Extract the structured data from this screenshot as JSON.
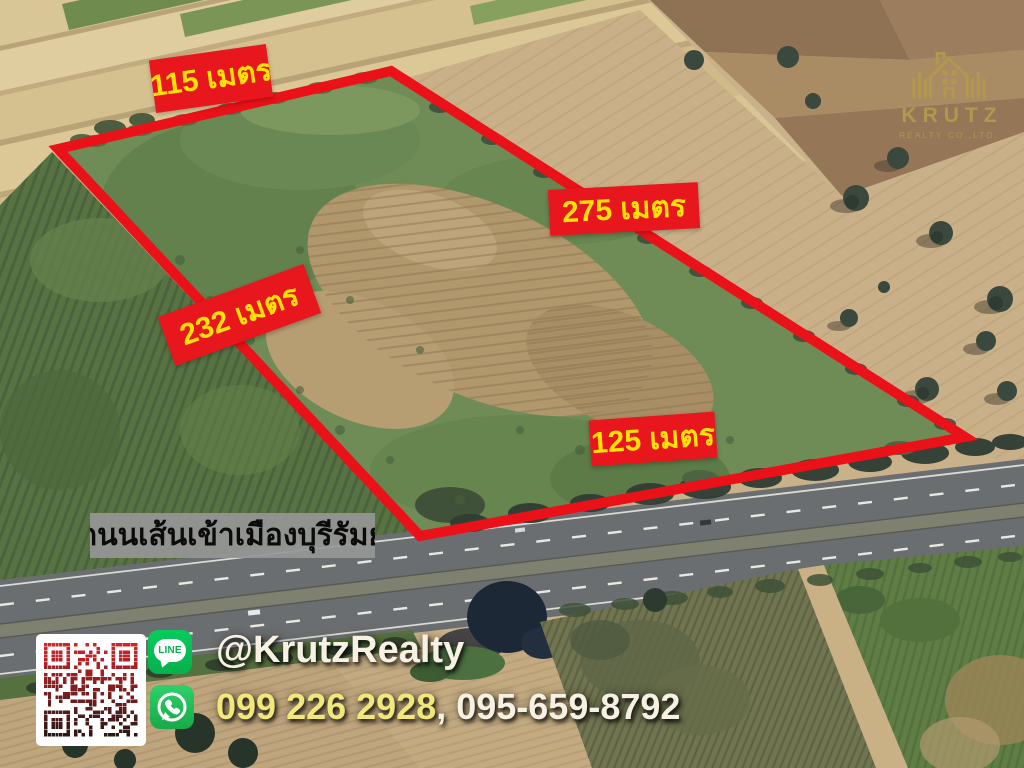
{
  "logo": {
    "name": "KRUTZ",
    "subtitle": "REALTY CO.,LTD.",
    "color": "#b3974e"
  },
  "parcel": {
    "side_labels": {
      "top": "115 เมตร",
      "right": "275 เมตร",
      "left": "232 เมตร",
      "bottom": "125 เมตร"
    },
    "boundary_color": "#ea1118",
    "label_background": "#e8161d",
    "label_text_color": "#ffe204"
  },
  "road": {
    "name": "ถนนเส้นเข้าเมืองบุรีรัมย์"
  },
  "contact": {
    "line_label": "LINE",
    "line_handle": "@KrutzRealty",
    "phone_primary": "099 226 2928",
    "phone_separator": ", ",
    "phone_secondary": "095-659-8792",
    "phone_primary_color": "#f1e87c",
    "text_color": "#f6f1e2"
  }
}
